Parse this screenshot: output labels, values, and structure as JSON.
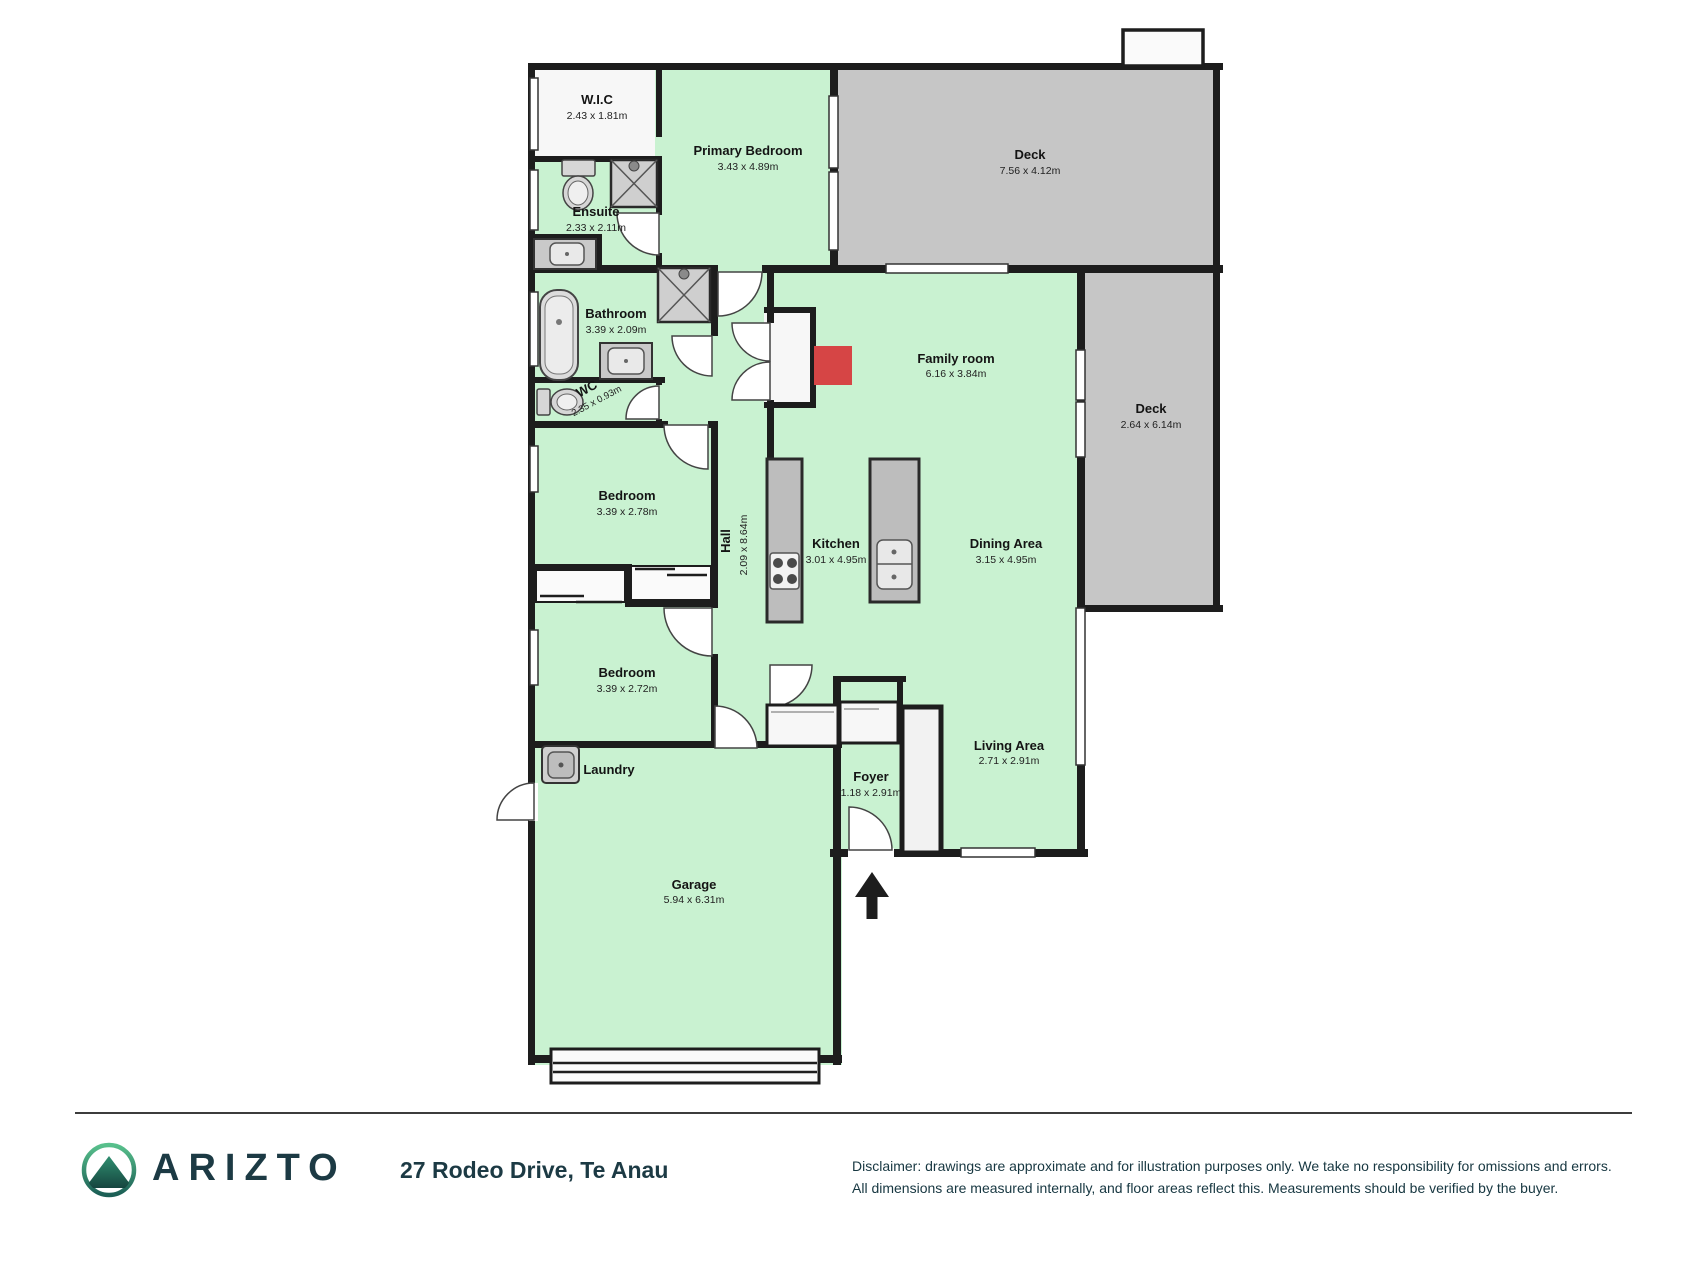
{
  "rooms": [
    {
      "name": "W.I.C",
      "dims": "2.43 x 1.81m"
    },
    {
      "name": "Primary Bedroom",
      "dims": "3.43 x 4.89m"
    },
    {
      "name": "Deck",
      "dims": "7.56 x 4.12m"
    },
    {
      "name": "Ensuite",
      "dims": "2.33 x 2.11m"
    },
    {
      "name": "Bathroom",
      "dims": "3.39 x 2.09m"
    },
    {
      "name": "WC",
      "dims": "2.35 x 0.93m"
    },
    {
      "name": "Family room",
      "dims": "6.16 x 3.84m"
    },
    {
      "name": "Deck",
      "dims": "2.64 x 6.14m"
    },
    {
      "name": "Bedroom",
      "dims": "3.39 x 2.78m"
    },
    {
      "name": "Hall",
      "dims": "2.09 x 8.64m"
    },
    {
      "name": "Kitchen",
      "dims": "3.01 x 4.95m"
    },
    {
      "name": "Dining Area",
      "dims": "3.15 x 4.95m"
    },
    {
      "name": "Bedroom",
      "dims": "3.39 x 2.72m"
    },
    {
      "name": "Living Area",
      "dims": "2.71 x 2.91m"
    },
    {
      "name": "Laundry",
      "dims": ""
    },
    {
      "name": "Foyer",
      "dims": "1.18 x 2.91m"
    },
    {
      "name": "Garage",
      "dims": "5.94 x 6.31m"
    }
  ],
  "footer": {
    "brand": "ARIZTO",
    "address": "27 Rodeo Drive, Te Anau",
    "disclaimer_line1": "Disclaimer: drawings are approximate and for illustration purposes only. We take no responsibility for omissions and errors.",
    "disclaimer_line2": "All dimensions are measured internally, and floor areas reflect this. Measurements should be verified by the buyer."
  },
  "colors": {
    "room_green": "#c9f2d1",
    "deck_gray": "#c6c6c6",
    "wall_black": "#1d1d1d",
    "fixture_gray": "#c9c9c9",
    "fireplace_red": "#d64545",
    "brand_teal": "#1c3a44",
    "logo_green": "#58c08c",
    "logo_dark_teal": "#1b5e55"
  }
}
